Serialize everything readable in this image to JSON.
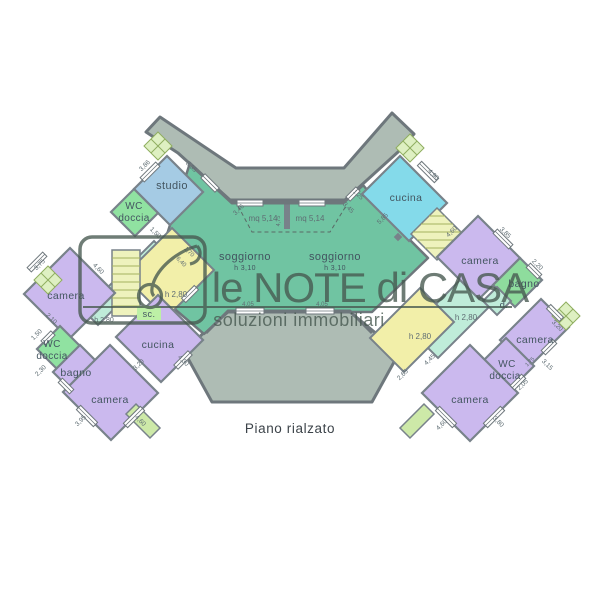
{
  "watermark": {
    "title": "le NOTE di CASA",
    "subtitle": "soluzioni immobiliari"
  },
  "caption": "Piano rialzato",
  "rooms": {
    "studio": "studio",
    "wc1a": "WC",
    "wc1b": "doccia",
    "camera_lt": "camera",
    "wc2a": "WC",
    "wc2b": "doccia",
    "bagno_l": "bagno",
    "camera_bl": "camera",
    "cucina_l": "cucina",
    "sogg_l": "soggiorno",
    "sogg_lh": "h 3,10",
    "sogg_r": "soggiorno",
    "sogg_rh": "h 3,10",
    "cucina_r": "cucina",
    "camera_rt": "camera",
    "bagno_r": "bagno",
    "dis": "d.",
    "camera_rm": "camera",
    "wc3a": "WC",
    "wc3b": "doccia",
    "camera_rb": "camera",
    "sc": "sc."
  },
  "dims": {
    "studio_a": "3,86",
    "studio_b": "3,35",
    "wc1_a": "1,50",
    "cam_lt_a": "3,75",
    "cam_lt_b": "4,60",
    "wc2_a": "1,50",
    "wc2_b": "2,10",
    "bagno_l_a": "2,30",
    "cam_bl_a": "3,95",
    "cam_bl_b": "4,60",
    "cuc_l_a": "3,20",
    "cuc_l_b": "4,30",
    "yel_l_a": "1,70",
    "yel_l_b": "6,40",
    "yel_l_h": "h 2,80",
    "cor_l_h": "h 2,80",
    "sog_a": "3,46",
    "sog_b": "3,45",
    "mq_l": "mq 5,14",
    "mq_r": "mq 5,14",
    "c475": "4,75",
    "win_l": "4,05",
    "win_r": "4,05",
    "cuc_r_a": "4,90",
    "cuc_r_b": "5,85",
    "cuc_r_c": "1,25",
    "cam_rt_a": "4,60",
    "cam_rt_b": "3,85",
    "bagno_r_a": "2,20",
    "yel_r_h": "h 2,80",
    "teal_r_h": "h 2,80",
    "yel_r_a": "4,45",
    "yel_r_b": "2,65",
    "cam_rm_a": "3,20",
    "cam_rm_b": "3,15",
    "wc3_a": "2,05",
    "wc3_b": "1,75",
    "cam_rb_a": "4,60",
    "cam_rb_b": "3,80"
  },
  "colors": {
    "terrace": "#aebcb4",
    "soggiorno": "#70c4a2",
    "studio": "#a5cbe4",
    "cucina_cyan": "#84daea",
    "camera": "#cbb9ee",
    "bagno": "#8edc9d",
    "wc_green": "#90e2a1",
    "mint": "#bfecd9",
    "yellow": "#f2efa9",
    "stairs": "#eef2bd",
    "checker": "#def0c2",
    "balcony": "#cde9a8",
    "sc_tag": "#bdf0a6",
    "wall": "#78828a",
    "watermark": "#46584f"
  }
}
